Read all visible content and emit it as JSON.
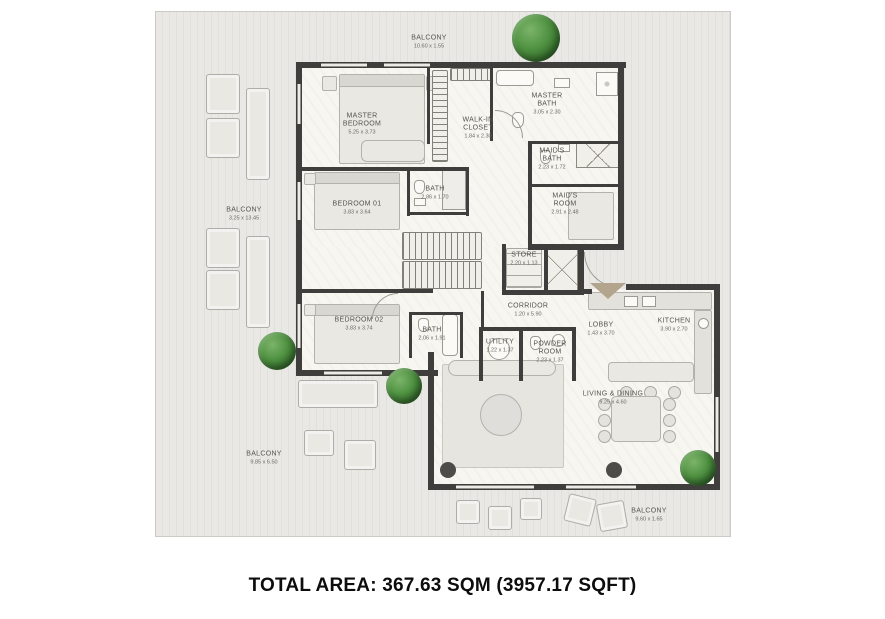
{
  "footer": {
    "total_area": "TOTAL AREA: 367.63 SQM (3957.17 SQFT)"
  },
  "floorplan": {
    "balconies": [
      {
        "name": "BALCONY",
        "dims": "10.60 x 1.55"
      },
      {
        "name": "BALCONY",
        "dims": "3.25 x 13.45"
      },
      {
        "name": "BALCONY",
        "dims": "9.85 x 6.50"
      },
      {
        "name": "BALCONY",
        "dims": "9.60 x 1.65"
      }
    ],
    "rooms": [
      {
        "name": "MASTER BEDROOM",
        "dims": "5.25 x 3.73"
      },
      {
        "name": "WALK-IN CLOSET",
        "dims": "1.84 x 2.30"
      },
      {
        "name": "MASTER BATH",
        "dims": "3.05 x 2.30"
      },
      {
        "name": "MAID'S BATH",
        "dims": "2.23 x 1.72"
      },
      {
        "name": "MAID'S ROOM",
        "dims": "2.91 x 2.48"
      },
      {
        "name": "BEDROOM 01",
        "dims": "3.83 x 3.64"
      },
      {
        "name": "BATH",
        "dims": "2.86 x 1.70"
      },
      {
        "name": "BEDROOM 02",
        "dims": "3.83 x 3.74"
      },
      {
        "name": "BATH",
        "dims": "2.06 x 1.91"
      },
      {
        "name": "STORE",
        "dims": "2.20 x 1.13"
      },
      {
        "name": "CORRIDOR",
        "dims": "1.20 x 5.90"
      },
      {
        "name": "UTILITY",
        "dims": "1.22 x 1.37"
      },
      {
        "name": "POWDER ROOM",
        "dims": "2.23 x 1.37"
      },
      {
        "name": "LOBBY",
        "dims": "1.43 x 3.70"
      },
      {
        "name": "KITCHEN",
        "dims": "3.90 x 2.70"
      },
      {
        "name": "LIVING & DINING",
        "dims": "9.25 x 4.60"
      }
    ],
    "colors": {
      "wall": "#3f3e3c",
      "deck_background": "#e9e8e4",
      "interior_background": "#f7f6f1",
      "tree_green": "#3e7c36",
      "entrance_arrow": "#b3a48e",
      "label_text": "#55544f",
      "footer_text": "#0d0d0d"
    }
  }
}
